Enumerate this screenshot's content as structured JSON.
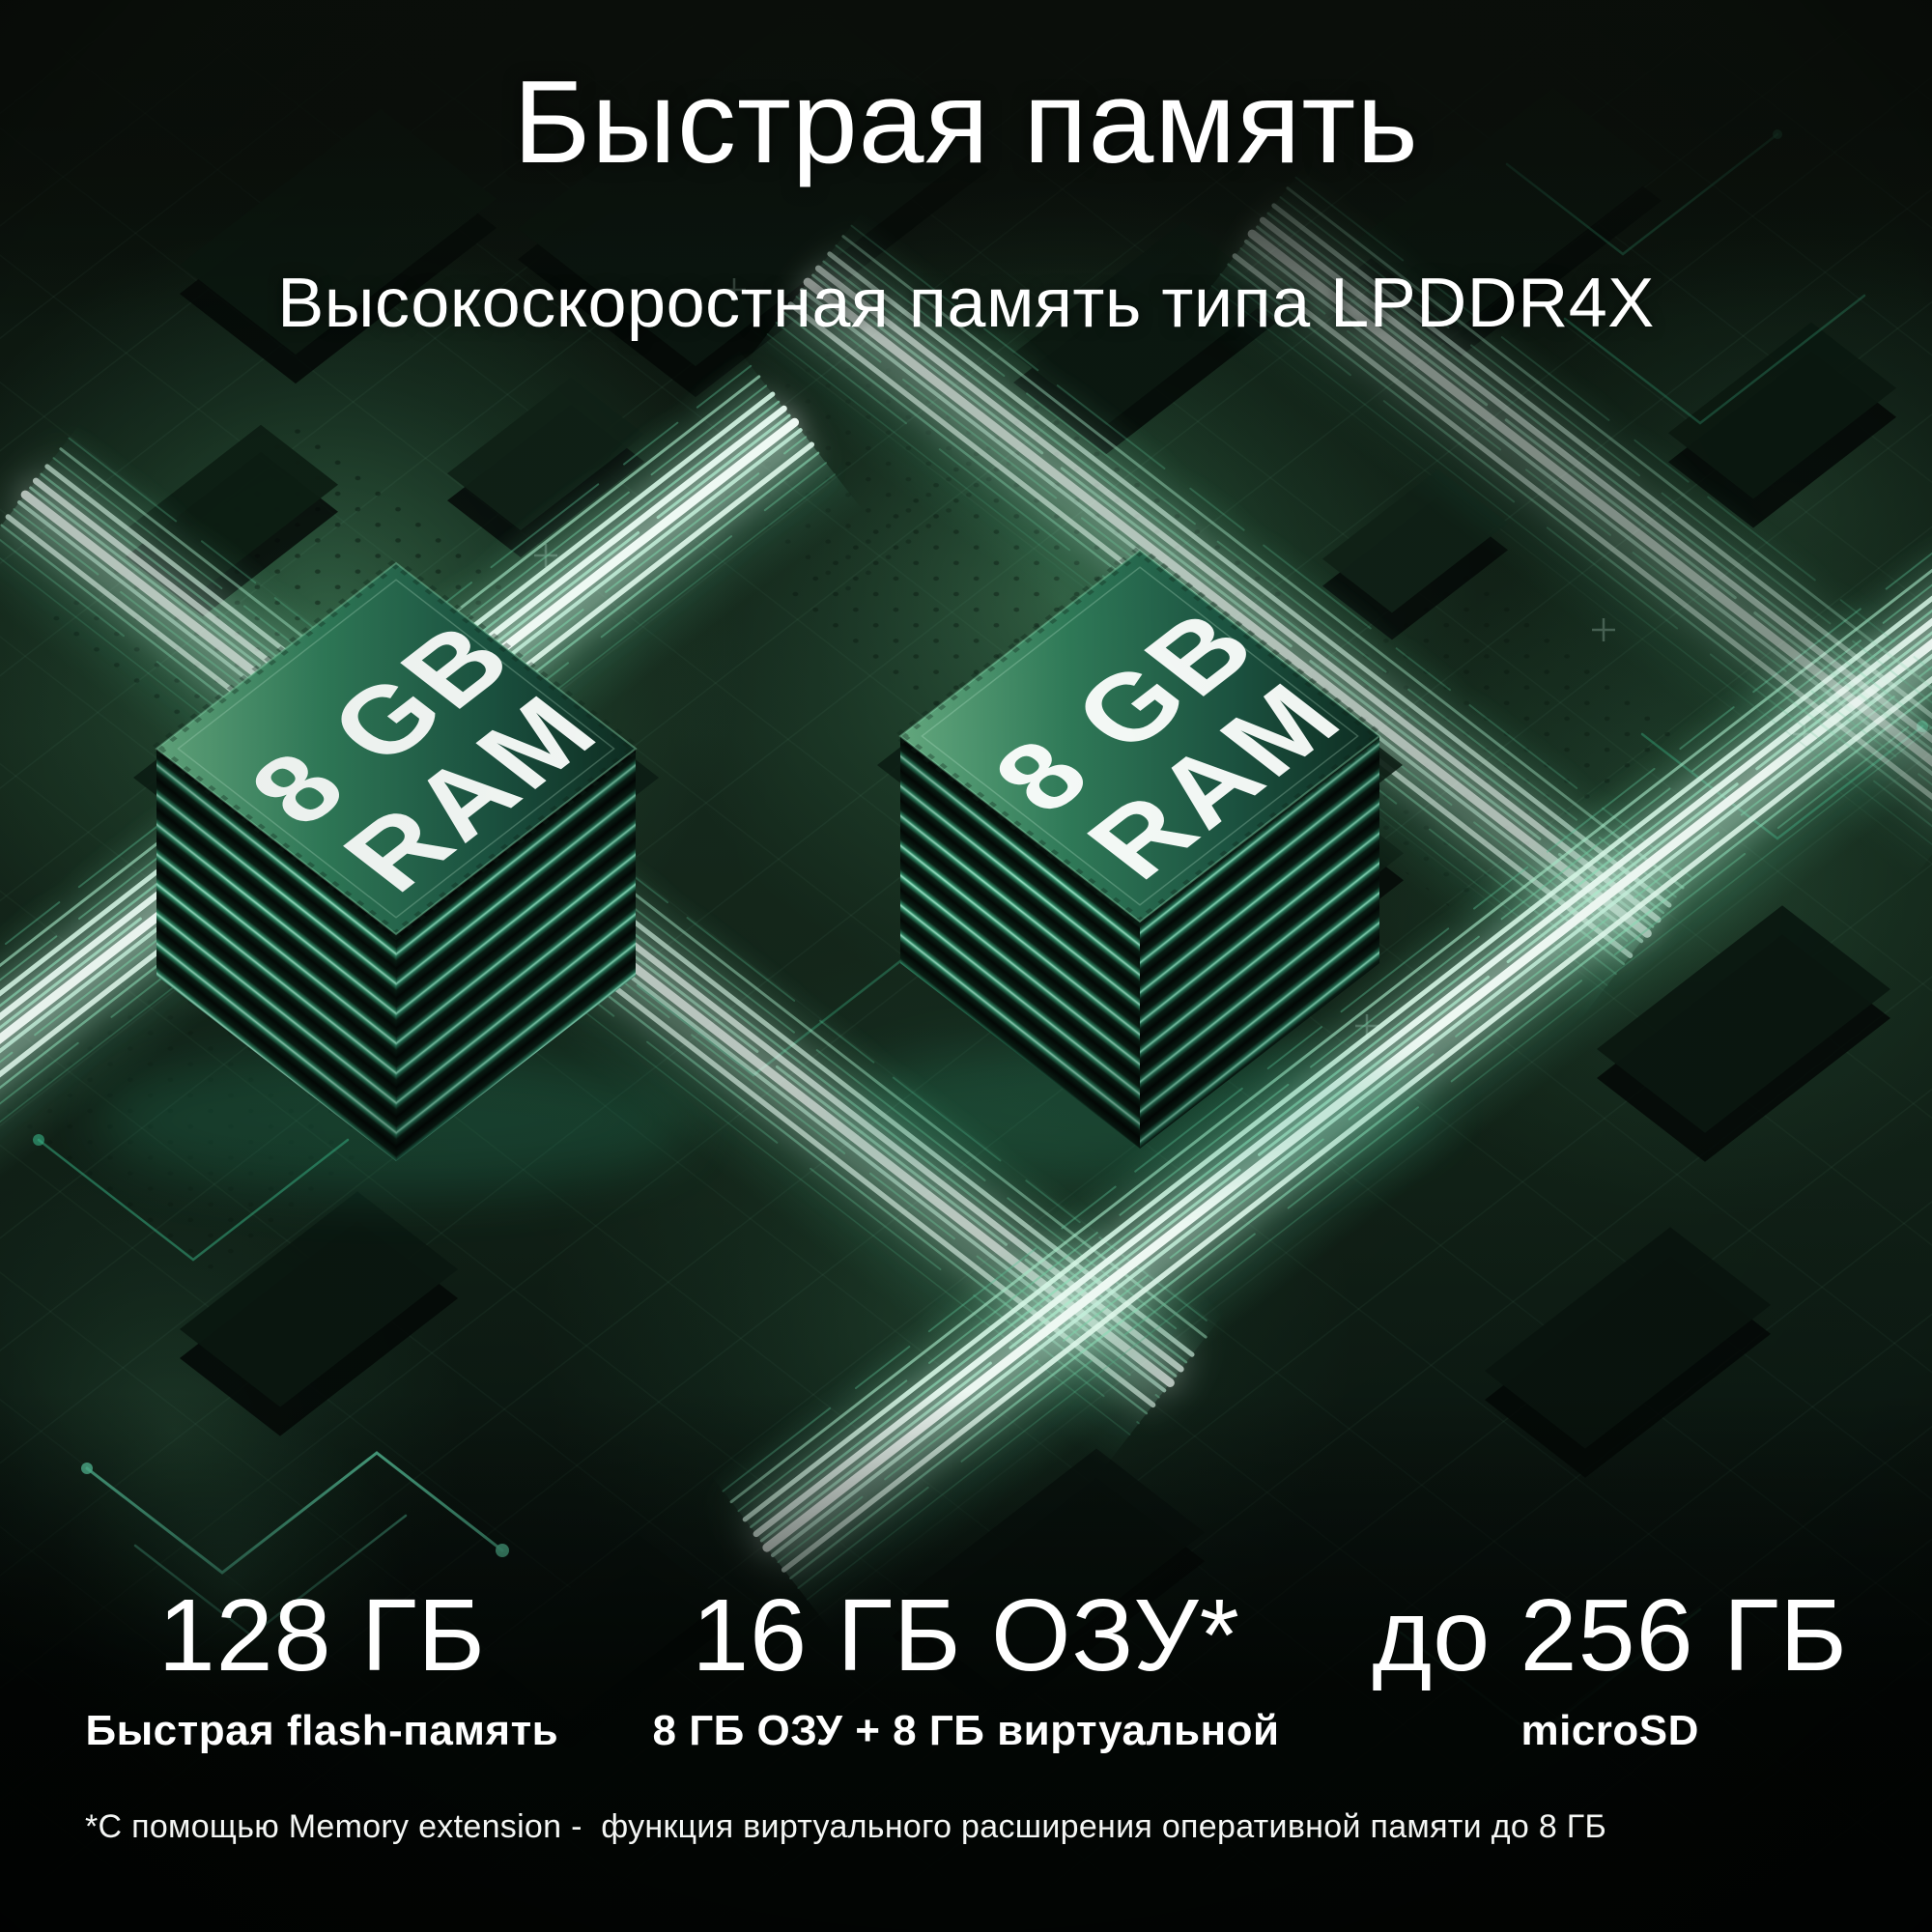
{
  "page": {
    "title": "Быстрая память",
    "subtitle": "Высокоскоростная память типа LPDDR4X"
  },
  "chips": {
    "label_line1": "8 GB",
    "label_line2": "RAM"
  },
  "specs": [
    {
      "value": "128 ГБ",
      "caption": "Быстрая flash-память"
    },
    {
      "value": "16 ГБ ОЗУ*",
      "caption": "8 ГБ ОЗУ + 8 ГБ виртуальной"
    },
    {
      "value": "до 256 ГБ",
      "caption": "microSD"
    }
  ],
  "footnote": "*С помощью Memory extension -  функция виртуального расширения оперативной памяти до 8 ГБ",
  "colors": {
    "background_dark": "#070b08",
    "board_green": "#14271b",
    "chip_green": "#2f7a58",
    "beam_core": "#f4fff9",
    "beam_glow": "#49b186",
    "trace_teal": "#3bbd8d",
    "text": "#ffffff"
  }
}
